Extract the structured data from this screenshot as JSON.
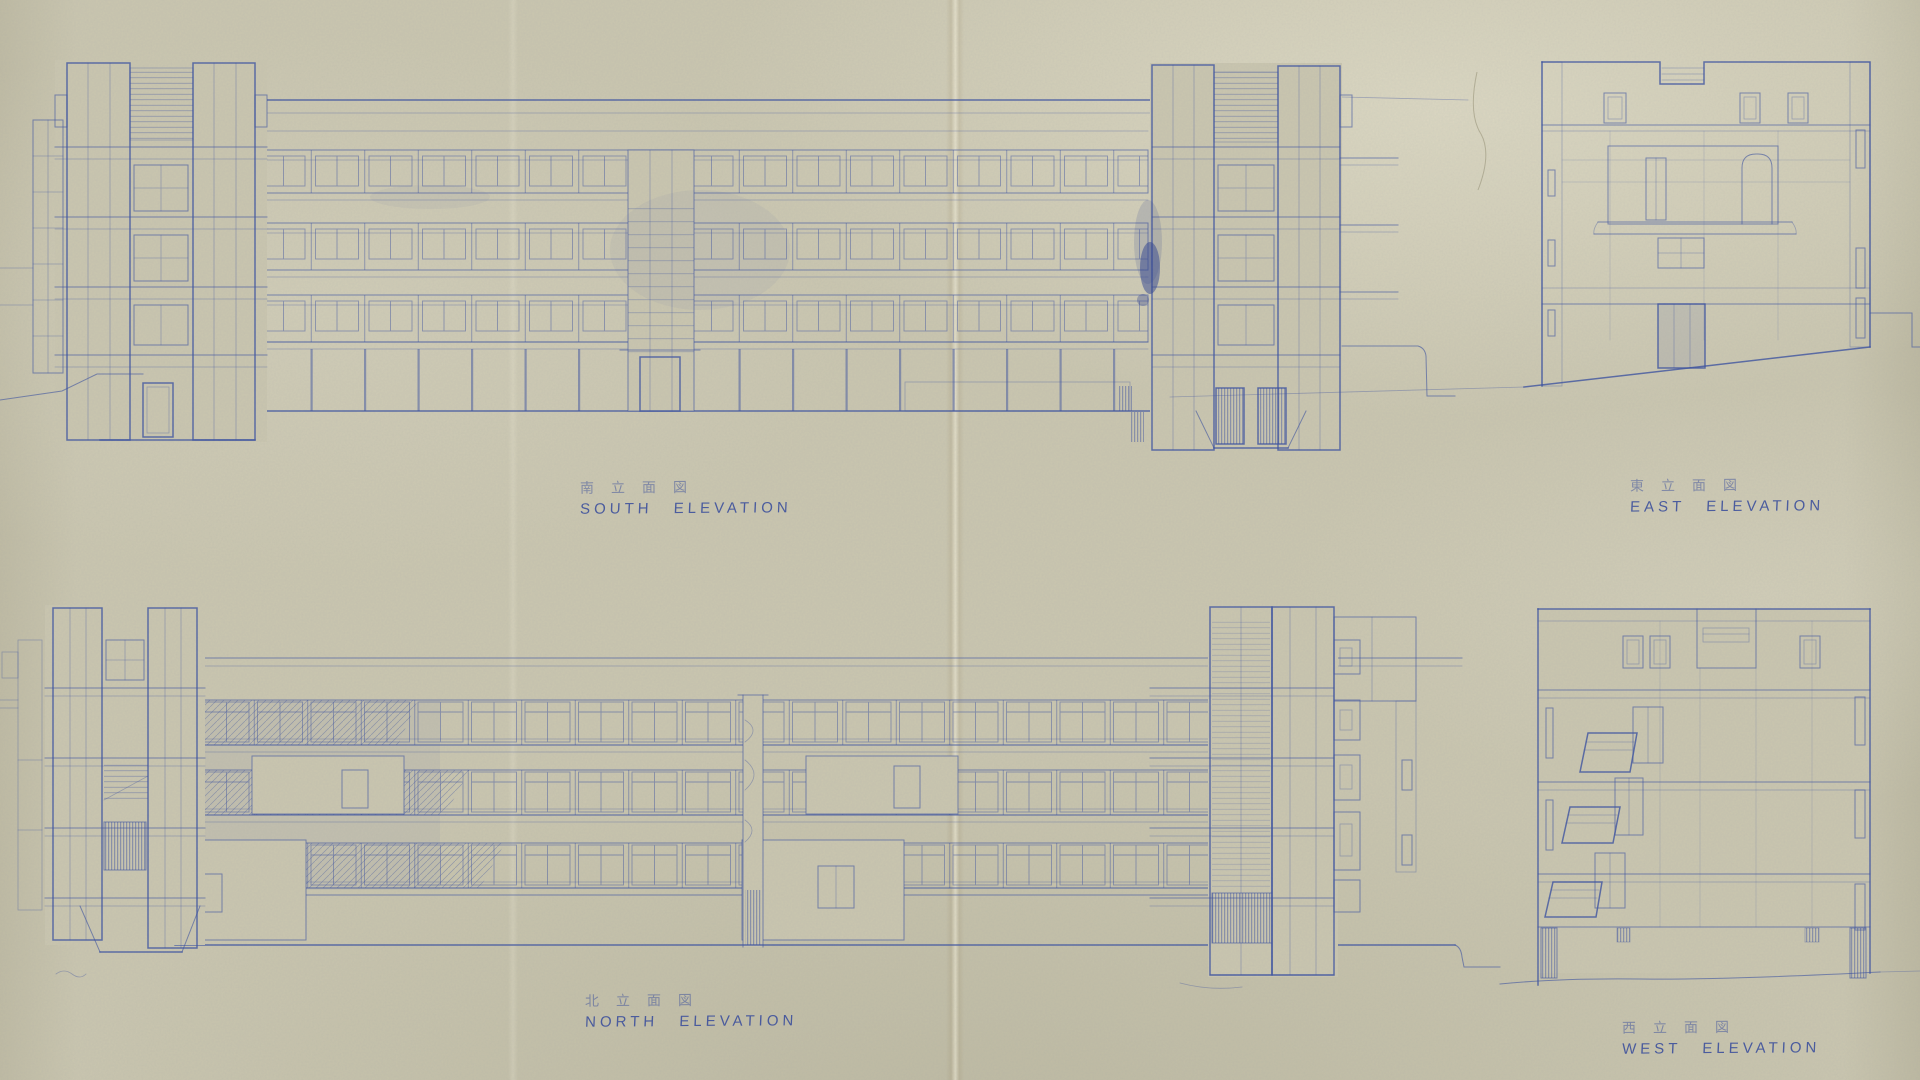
{
  "sheet": {
    "labels": {
      "south": {
        "jp": "南立面図",
        "en": "SOUTH ELEVATION"
      },
      "east": {
        "jp": "東立面図",
        "en": "EAST ELEVATION"
      },
      "north": {
        "jp": "北立面図",
        "en": "NORTH ELEVATION"
      },
      "west": {
        "jp": "西立面図",
        "en": "WEST ELEVATION"
      }
    },
    "colors": {
      "paper": "#cac6af",
      "ink": "#3a50a0",
      "crease": "#b8a780"
    }
  }
}
